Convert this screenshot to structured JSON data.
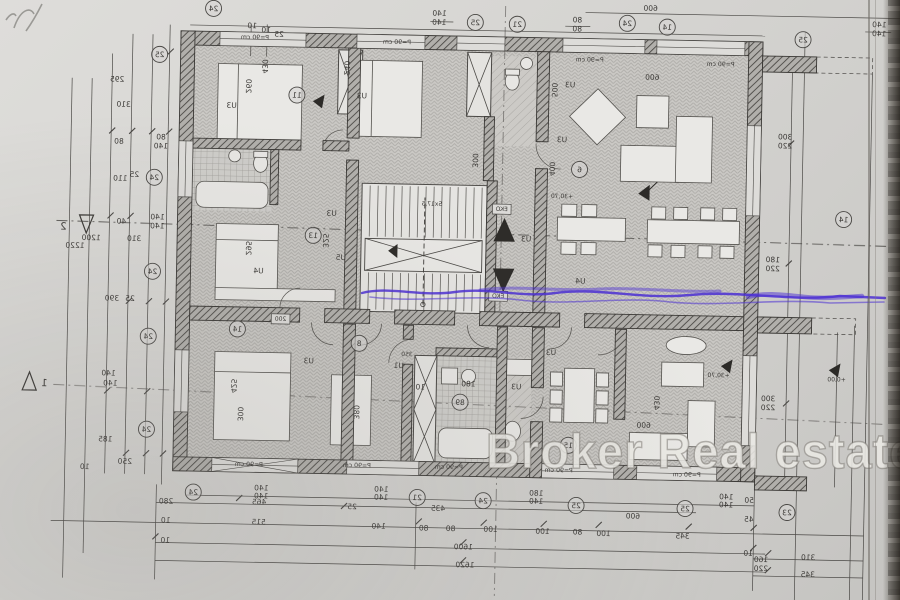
{
  "watermark": {
    "text": "Broker Real estate",
    "color": "#e9e8e4"
  },
  "annotation": {
    "color": "#4b2fd4",
    "type": "pen-scribble"
  },
  "plan": {
    "orientation": "mirrored-scan",
    "tilt_deg": 1.1,
    "line_color": "#3c3a37",
    "paper_color": "#d5d4d1"
  },
  "labels": [
    {
      "t": "295",
      "x": 113,
      "y": 88
    },
    {
      "t": "310",
      "x": 120,
      "y": 113
    },
    {
      "t": "80",
      "x": 116,
      "y": 150
    },
    {
      "t": "80",
      "x": 158,
      "y": 145
    },
    {
      "t": "140",
      "x": 158,
      "y": 154
    },
    {
      "t": "110",
      "x": 118,
      "y": 187
    },
    {
      "t": "25",
      "x": 132,
      "y": 183
    },
    {
      "t": "140",
      "x": 156,
      "y": 225
    },
    {
      "t": "140",
      "x": 156,
      "y": 234
    },
    {
      "t": "40",
      "x": 120,
      "y": 230
    },
    {
      "t": "310",
      "x": 133,
      "y": 247
    },
    {
      "t": "1200",
      "x": 90,
      "y": 247
    },
    {
      "t": "1220",
      "x": 74,
      "y": 255
    },
    {
      "t": "390",
      "x": 112,
      "y": 307
    },
    {
      "t": "25",
      "x": 130,
      "y": 307
    },
    {
      "t": "140",
      "x": 110,
      "y": 382
    },
    {
      "t": "140",
      "x": 112,
      "y": 392
    },
    {
      "t": "185",
      "x": 108,
      "y": 448
    },
    {
      "t": "250",
      "x": 128,
      "y": 470
    },
    {
      "t": "10",
      "x": 88,
      "y": 476
    },
    {
      "t": "10",
      "x": 247,
      "y": 32
    },
    {
      "t": "10",
      "x": 261,
      "y": 36
    },
    {
      "t": "25",
      "x": 274,
      "y": 40
    },
    {
      "t": "140",
      "x": 434,
      "y": 16
    },
    {
      "t": "140",
      "x": 434,
      "y": 25
    },
    {
      "t": "80",
      "x": 572,
      "y": 20
    },
    {
      "t": "80",
      "x": 572,
      "y": 29
    },
    {
      "t": "600",
      "x": 645,
      "y": 7
    },
    {
      "t": "140",
      "x": 874,
      "y": 19
    },
    {
      "t": "140",
      "x": 874,
      "y": 28
    },
    {
      "t": "300",
      "x": 782,
      "y": 133
    },
    {
      "t": "220",
      "x": 782,
      "y": 142
    },
    {
      "t": "180",
      "x": 772,
      "y": 256
    },
    {
      "t": "220",
      "x": 772,
      "y": 265
    },
    {
      "t": "300",
      "x": 770,
      "y": 395
    },
    {
      "t": "220",
      "x": 770,
      "y": 404
    },
    {
      "t": "160",
      "x": 766,
      "y": 556
    },
    {
      "t": "220",
      "x": 766,
      "y": 565
    },
    {
      "t": "50",
      "x": 753,
      "y": 497
    },
    {
      "t": "45",
      "x": 753,
      "y": 516
    },
    {
      "t": "10",
      "x": 753,
      "y": 550
    },
    {
      "t": "140",
      "x": 265,
      "y": 494
    },
    {
      "t": "140",
      "x": 265,
      "y": 502
    },
    {
      "t": "140",
      "x": 385,
      "y": 493
    },
    {
      "t": "140",
      "x": 385,
      "y": 501
    },
    {
      "t": "180",
      "x": 540,
      "y": 494
    },
    {
      "t": "140",
      "x": 540,
      "y": 502
    },
    {
      "t": "140",
      "x": 730,
      "y": 494
    },
    {
      "t": "140",
      "x": 730,
      "y": 502
    },
    {
      "t": "280",
      "x": 170,
      "y": 509
    },
    {
      "t": "465",
      "x": 263,
      "y": 508
    },
    {
      "t": "25",
      "x": 356,
      "y": 511
    },
    {
      "t": "435",
      "x": 442,
      "y": 511
    },
    {
      "t": "600",
      "x": 637,
      "y": 515
    },
    {
      "t": "10",
      "x": 170,
      "y": 528
    },
    {
      "t": "515",
      "x": 263,
      "y": 528
    },
    {
      "t": "140",
      "x": 383,
      "y": 530
    },
    {
      "t": "80",
      "x": 428,
      "y": 531
    },
    {
      "t": "80",
      "x": 455,
      "y": 531
    },
    {
      "t": "100",
      "x": 495,
      "y": 531
    },
    {
      "t": "100",
      "x": 547,
      "y": 532
    },
    {
      "t": "80",
      "x": 582,
      "y": 532
    },
    {
      "t": "100",
      "x": 608,
      "y": 533
    },
    {
      "t": "345",
      "x": 687,
      "y": 534
    },
    {
      "t": "10",
      "x": 170,
      "y": 548
    },
    {
      "t": "1600",
      "x": 468,
      "y": 549
    },
    {
      "t": "310",
      "x": 813,
      "y": 553
    },
    {
      "t": "1620",
      "x": 470,
      "y": 567
    },
    {
      "t": "345",
      "x": 813,
      "y": 570
    },
    {
      "t": "430",
      "x": 258,
      "y": 70,
      "r": 90
    },
    {
      "t": "260",
      "x": 242,
      "y": 90,
      "r": 90
    },
    {
      "t": "U3",
      "x": 228,
      "y": 112
    },
    {
      "t": "U3",
      "x": 358,
      "y": 100
    },
    {
      "t": "240",
      "x": 340,
      "y": 70,
      "r": 90
    },
    {
      "t": "500",
      "x": 548,
      "y": 88,
      "r": 90
    },
    {
      "t": "U3",
      "x": 566,
      "y": 85
    },
    {
      "t": "400",
      "x": 547,
      "y": 167,
      "r": 90
    },
    {
      "t": "U3",
      "x": 559,
      "y": 140
    },
    {
      "t": "600",
      "x": 648,
      "y": 76
    },
    {
      "t": "P=90 cm",
      "x": 250,
      "y": 43,
      "s": 6.2
    },
    {
      "t": "P=90 cm",
      "x": 392,
      "y": 45,
      "s": 6.2
    },
    {
      "t": "P=90 cm",
      "x": 585,
      "y": 59,
      "s": 6.2
    },
    {
      "t": "P=90 cm",
      "x": 716,
      "y": 61,
      "s": 6.2
    },
    {
      "t": "P=90 cm",
      "x": 252,
      "y": 470,
      "s": 6.2
    },
    {
      "t": "P=90 cm",
      "x": 360,
      "y": 469,
      "s": 6.2
    },
    {
      "t": "P=90 cm",
      "x": 452,
      "y": 469,
      "s": 6.2
    },
    {
      "t": "P=90 cm",
      "x": 562,
      "y": 470,
      "s": 6.2
    },
    {
      "t": "P=90 cm",
      "x": 690,
      "y": 472,
      "s": 6.2
    },
    {
      "t": "EKO",
      "x": 500,
      "y": 210,
      "box": true,
      "s": 6
    },
    {
      "t": "EKO",
      "x": 498,
      "y": 297,
      "box": true,
      "s": 6
    },
    {
      "t": "200",
      "x": 281,
      "y": 324,
      "box": true,
      "s": 6
    },
    {
      "t": "5x17,5",
      "x": 430,
      "y": 206,
      "s": 6
    },
    {
      "t": "295",
      "x": 245,
      "y": 252,
      "r": 90
    },
    {
      "t": "325",
      "x": 322,
      "y": 243,
      "r": 90
    },
    {
      "t": "U3",
      "x": 330,
      "y": 218
    },
    {
      "t": "U4",
      "x": 258,
      "y": 277
    },
    {
      "t": "U5",
      "x": 340,
      "y": 262
    },
    {
      "t": "U4",
      "x": 580,
      "y": 281
    },
    {
      "t": "U3",
      "x": 525,
      "y": 240
    },
    {
      "t": "300",
      "x": 470,
      "y": 160,
      "r": 90
    },
    {
      "t": "425",
      "x": 233,
      "y": 390,
      "r": 90
    },
    {
      "t": "300",
      "x": 240,
      "y": 418,
      "r": 90
    },
    {
      "t": "U3",
      "x": 310,
      "y": 366
    },
    {
      "t": "380",
      "x": 356,
      "y": 414,
      "r": 90
    },
    {
      "t": "U1",
      "x": 400,
      "y": 369
    },
    {
      "t": "350",
      "x": 408,
      "y": 357,
      "s": 6
    },
    {
      "t": "180",
      "x": 470,
      "y": 386
    },
    {
      "t": "10",
      "x": 422,
      "y": 390
    },
    {
      "t": "U3",
      "x": 518,
      "y": 388
    },
    {
      "t": "U3",
      "x": 552,
      "y": 353
    },
    {
      "t": "430",
      "x": 656,
      "y": 399,
      "r": 90
    },
    {
      "t": "600",
      "x": 646,
      "y": 424
    },
    {
      "t": "+30,70",
      "x": 720,
      "y": 372,
      "s": 6
    },
    {
      "t": "+0,00",
      "x": 838,
      "y": 374,
      "s": 6
    },
    {
      "t": "+30,70",
      "x": 560,
      "y": 196,
      "s": 6
    },
    {
      "t": "2",
      "x": 62,
      "y": 237,
      "s": 10
    },
    {
      "t": "1",
      "x": 46,
      "y": 394,
      "s": 10
    }
  ],
  "circle_markers": [
    {
      "t": "24",
      "x": 208,
      "y": 13
    },
    {
      "t": "25",
      "x": 155,
      "y": 60
    },
    {
      "t": "25",
      "x": 470,
      "y": 22
    },
    {
      "t": "21",
      "x": 512,
      "y": 23
    },
    {
      "t": "24",
      "x": 622,
      "y": 20
    },
    {
      "t": "14",
      "x": 662,
      "y": 23
    },
    {
      "t": "25",
      "x": 798,
      "y": 33
    },
    {
      "t": "24",
      "x": 152,
      "y": 183
    },
    {
      "t": "24",
      "x": 152,
      "y": 277
    },
    {
      "t": "24",
      "x": 149,
      "y": 342
    },
    {
      "t": "24",
      "x": 149,
      "y": 435
    },
    {
      "t": "14",
      "x": 842,
      "y": 212
    },
    {
      "t": "11",
      "x": 293,
      "y": 98
    },
    {
      "t": "13",
      "x": 312,
      "y": 238
    },
    {
      "t": "6",
      "x": 577,
      "y": 167
    },
    {
      "t": "14",
      "x": 238,
      "y": 333
    },
    {
      "t": "8",
      "x": 360,
      "y": 345
    },
    {
      "t": "89",
      "x": 462,
      "y": 402
    },
    {
      "t": "15",
      "x": 571,
      "y": 443
    },
    {
      "t": "24",
      "x": 197,
      "y": 497
    },
    {
      "t": "21",
      "x": 421,
      "y": 498
    },
    {
      "t": "24",
      "x": 487,
      "y": 500
    },
    {
      "t": "25",
      "x": 580,
      "y": 503
    },
    {
      "t": "25",
      "x": 689,
      "y": 504
    },
    {
      "t": "23",
      "x": 791,
      "y": 506
    }
  ]
}
